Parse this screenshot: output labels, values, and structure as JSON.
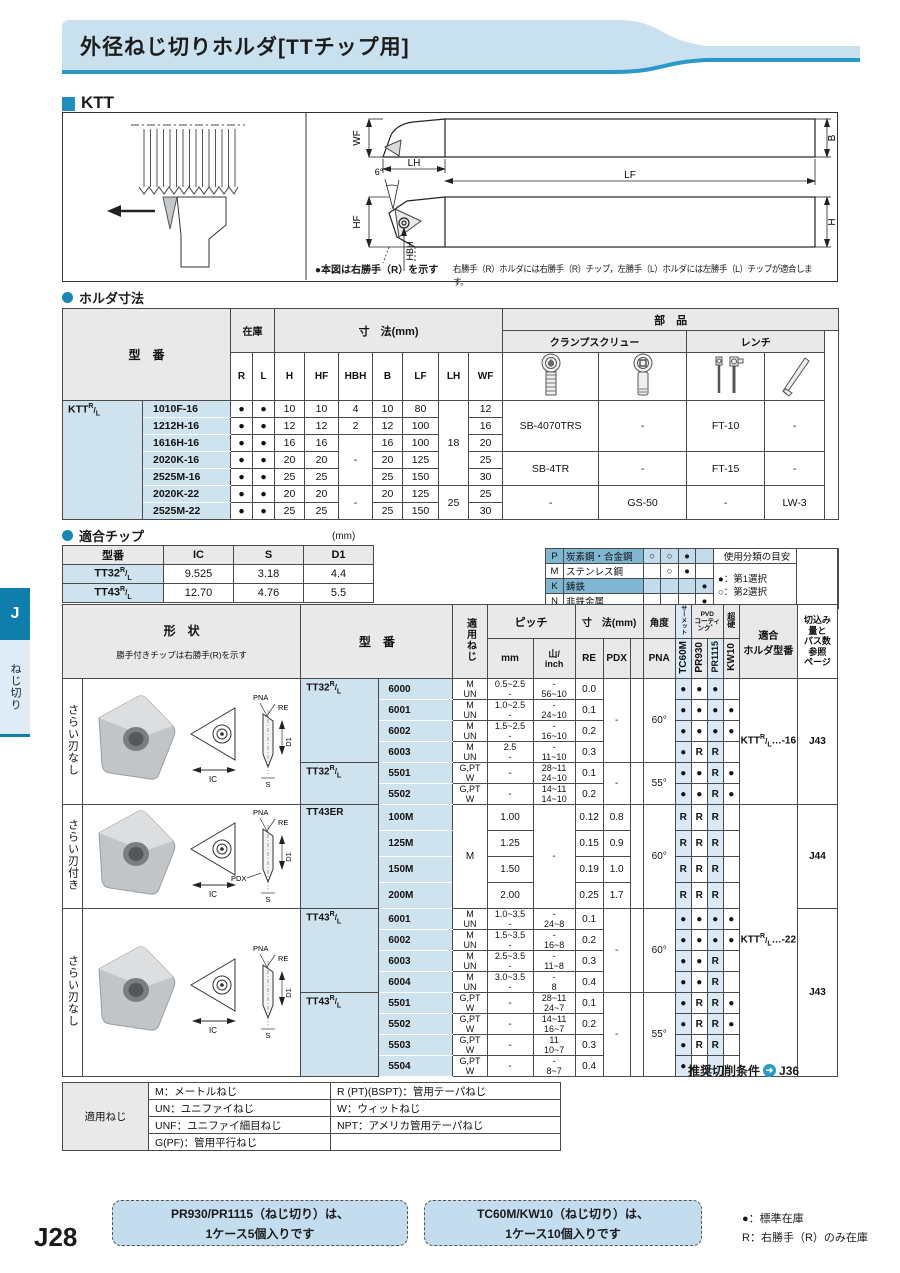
{
  "tab": {
    "letter": "J",
    "label": "ねじ切り"
  },
  "page_no": "J28",
  "header": {
    "title": "外径ねじ切りホルダ[TTチップ用]"
  },
  "ktt": {
    "label": "KTT"
  },
  "diagram": {
    "dims": {
      "wf": "WF",
      "b": "B",
      "lh": "LH",
      "lf": "LF",
      "deg": "6°",
      "hf": "HF",
      "hbh": "HBH",
      "h": "H"
    },
    "note_left": "●本図は右勝手（R）を示す",
    "note_right": "右勝手（R）ホルダには右勝手（R）チップ，左勝手（L）ホルダには左勝手（L）チップが適合します。"
  },
  "holder": {
    "title": "ホルダ寸法",
    "h": {
      "model": "型　番",
      "stock": "在庫",
      "dims": "寸　法(mm)",
      "parts": "部　品",
      "screw": "クランプスクリュー",
      "wrench": "レンチ",
      "r": "R",
      "l": "L",
      "c1": "H",
      "c2": "HF",
      "c3": "HBH",
      "c4": "B",
      "c5": "LF",
      "c6": "LH",
      "c7": "WF"
    },
    "prefix": {
      "base": "KTT",
      "rt": "R",
      "rb": "L"
    },
    "rows": [
      {
        "model": "1010F-16",
        "H": "10",
        "HF": "10",
        "HBH": "4",
        "B": "10",
        "LF": "80",
        "WF": "12"
      },
      {
        "model": "1212H-16",
        "H": "12",
        "HF": "12",
        "HBH": "2",
        "B": "12",
        "LF": "100",
        "WF": "16"
      },
      {
        "model": "1616H-16",
        "H": "16",
        "HF": "16",
        "B": "16",
        "LF": "100",
        "WF": "20"
      },
      {
        "model": "2020K-16",
        "H": "20",
        "HF": "20",
        "B": "20",
        "LF": "125",
        "WF": "25"
      },
      {
        "model": "2525M-16",
        "H": "25",
        "HF": "25",
        "B": "25",
        "LF": "150",
        "WF": "30"
      },
      {
        "model": "2020K-22",
        "H": "20",
        "HF": "20",
        "B": "20",
        "LF": "125",
        "WF": "25"
      },
      {
        "model": "2525M-22",
        "H": "25",
        "HF": "25",
        "B": "25",
        "LF": "150",
        "WF": "30"
      }
    ],
    "merged": {
      "hbh_mid": "-",
      "hbh_bot": "-",
      "lh_top": "18",
      "lh_bot": "25",
      "dot": "●"
    },
    "parts": [
      {
        "screw1": "SB-4070TRS",
        "screw2": "-",
        "wrench1": "FT-10",
        "wrench2": "-"
      },
      {
        "screw1": "SB-4TR",
        "screw2": "-",
        "wrench1": "FT-15",
        "wrench2": "-"
      },
      {
        "screw1": "-",
        "screw2": "GS-50",
        "wrench1": "-",
        "wrench2": "LW-3"
      }
    ]
  },
  "chip": {
    "title": "適合チップ",
    "unit": "(mm)",
    "h": {
      "model": "型番",
      "ic": "IC",
      "s": "S",
      "d1": "D1"
    },
    "rows": [
      {
        "base": "TT32",
        "rt": "R",
        "rb": "L",
        "ic": "9.525",
        "s": "3.18",
        "d1": "4.4"
      },
      {
        "base": "TT43",
        "rt": "R",
        "rb": "L",
        "ic": "12.70",
        "s": "4.76",
        "d1": "5.5"
      }
    ]
  },
  "legend": {
    "rows": [
      {
        "code": "P",
        "name": "炭素鋼・合金鋼",
        "m1": "○",
        "m2": "○",
        "m3": "●",
        "m4": ""
      },
      {
        "code": "M",
        "name": "ステンレス鋼",
        "m1": "",
        "m2": "○",
        "m3": "●",
        "m4": ""
      },
      {
        "code": "K",
        "name": "鋳鉄",
        "m1": "",
        "m2": "",
        "m3": "",
        "m4": "●"
      },
      {
        "code": "N",
        "name": "非鉄金属",
        "m1": "",
        "m2": "",
        "m3": "",
        "m4": "●"
      }
    ],
    "guide_title": "使用分類の目安",
    "first": "●：第1選択",
    "second": "○：第2選択"
  },
  "main": {
    "h": {
      "shape": "形　状",
      "shape_note": "勝手付きチップは右勝手(R)を示す",
      "model": "型　番",
      "thread": "適用ねじ",
      "pitch": "ピッチ",
      "mm": "mm",
      "inch1": "山/",
      "inch2": "inch",
      "dims": "寸　法(mm)",
      "re": "RE",
      "pdx": "PDX",
      "angle": "角度",
      "pna": "PNA",
      "cermet": "サーメット",
      "pvd1": "PVD",
      "pvd2": "コーティンク゛",
      "carbide": "超硬",
      "g1": "TC60M",
      "g2": "PR930",
      "g3": "PR1115",
      "g4": "KW10",
      "holder1": "適合",
      "holder2": "ホルダ型番",
      "pg1": "切込み",
      "pg2": "量と",
      "pg3": "パス数",
      "pg4": "参照",
      "pg5": "ページ"
    },
    "shape_labels": {
      "pna": "PNA",
      "re": "RE",
      "d1": "D1",
      "s": "S",
      "ic": "IC",
      "pdx": "PDX"
    },
    "rows": [
      {
        "glabel": "さらい刃なし",
        "pfx": "TT32",
        "rlt": "R",
        "rlb": "L",
        "no": "6000",
        "t1": "M",
        "t2": "UN",
        "m1": "0.5~2.5",
        "m2": "-",
        "i1": "-",
        "i2": "56~10",
        "re": "0.0",
        "pdx": "-",
        "pna": "60°",
        "c1": "●",
        "c2": "●",
        "c3": "●",
        "hb": "KTT",
        "hrt": "R",
        "hrb": "L",
        "ht": "…-16",
        "pg": "J43"
      },
      {
        "no": "6001",
        "t1": "M",
        "t2": "UN",
        "m1": "1.0~2.5",
        "m2": "-",
        "i1": "-",
        "i2": "24~10",
        "re": "0.1",
        "c1": "●",
        "c2": "●",
        "c3": "●",
        "c4": "●"
      },
      {
        "no": "6002",
        "t1": "M",
        "t2": "UN",
        "m1": "1.5~2.5",
        "m2": "-",
        "i1": "-",
        "i2": "16~10",
        "re": "0.2",
        "c1": "●",
        "c2": "●",
        "c3": "●",
        "c4": "●"
      },
      {
        "no": "6003",
        "t1": "M",
        "t2": "UN",
        "m1": "2.5",
        "m2": "-",
        "i1": "-",
        "i2": "11~10",
        "re": "0.3",
        "c1": "●",
        "c2": "R",
        "c3": "R"
      },
      {
        "pfx": "TT32",
        "rlt": "R",
        "rlb": "L",
        "no": "5501",
        "t1": "G,PT",
        "t2": "W",
        "m1": "-",
        "i1": "28~11",
        "i2": "24~10",
        "re": "0.1",
        "pdx": "-",
        "pna": "55°",
        "c1": "●",
        "c2": "●",
        "c3": "R",
        "c4": "●"
      },
      {
        "no": "5502",
        "t1": "G,PT",
        "t2": "W",
        "m1": "-",
        "i1": "14~11",
        "i2": "14~10",
        "re": "0.2",
        "c1": "●",
        "c2": "●",
        "c3": "R",
        "c4": "●"
      },
      {
        "glabel": "さらい刃付き",
        "pfx": "TT43ER",
        "no": "100M",
        "t1": "M",
        "m1": "1.00",
        "i1": "-",
        "re": "0.12",
        "pdx": "0.8",
        "pna": "60°",
        "c1": "R",
        "c2": "R",
        "c3": "R",
        "hb": "KTT",
        "hrt": "R",
        "hrb": "L",
        "ht": "…-22",
        "pg": "J44"
      },
      {
        "no": "125M",
        "m1": "1.25",
        "re": "0.15",
        "pdx": "0.9",
        "c1": "R",
        "c2": "R",
        "c3": "R"
      },
      {
        "no": "150M",
        "m1": "1.50",
        "re": "0.19",
        "pdx": "1.0",
        "c1": "R",
        "c2": "R",
        "c3": "R"
      },
      {
        "no": "200M",
        "m1": "2.00",
        "re": "0.25",
        "pdx": "1.7",
        "c1": "R",
        "c2": "R",
        "c3": "R"
      },
      {
        "glabel": "さらい刃なし",
        "pfx": "TT43",
        "rlt": "R",
        "rlb": "L",
        "no": "6001",
        "t1": "M",
        "t2": "UN",
        "m1": "1.0~3.5",
        "m2": "-",
        "i1": "-",
        "i2": "24~8",
        "re": "0.1",
        "pdx": "-",
        "pna": "60°",
        "c1": "●",
        "c2": "●",
        "c3": "●",
        "c4": "●",
        "pg": "J43"
      },
      {
        "no": "6002",
        "t1": "M",
        "t2": "UN",
        "m1": "1.5~3.5",
        "m2": "-",
        "i1": "-",
        "i2": "16~8",
        "re": "0.2",
        "c1": "●",
        "c2": "●",
        "c3": "●",
        "c4": "●"
      },
      {
        "no": "6003",
        "t1": "M",
        "t2": "UN",
        "m1": "2.5~3.5",
        "m2": "-",
        "i1": "-",
        "i2": "11~8",
        "re": "0.3",
        "c1": "●",
        "c2": "●",
        "c3": "R"
      },
      {
        "no": "6004",
        "t1": "M",
        "t2": "UN",
        "m1": "3.0~3.5",
        "m2": "-",
        "i1": "-",
        "i2": "8",
        "re": "0.4",
        "c1": "●",
        "c2": "●",
        "c3": "R"
      },
      {
        "pfx": "TT43",
        "rlt": "R",
        "rlb": "L",
        "no": "5501",
        "t1": "G,PT",
        "t2": "W",
        "m1": "-",
        "i1": "28~11",
        "i2": "24~7",
        "re": "0.1",
        "pdx": "-",
        "pna": "55°",
        "c1": "●",
        "c2": "R",
        "c3": "R",
        "c4": "●"
      },
      {
        "no": "5502",
        "t1": "G,PT",
        "t2": "W",
        "m1": "-",
        "i1": "14~11",
        "i2": "16~7",
        "re": "0.2",
        "c1": "●",
        "c2": "R",
        "c3": "R",
        "c4": "●"
      },
      {
        "no": "5503",
        "t1": "G,PT",
        "t2": "W",
        "m1": "-",
        "i1": "11",
        "i2": "10~7",
        "re": "0.3",
        "c1": "●",
        "c2": "R",
        "c3": "R"
      },
      {
        "no": "5504",
        "t1": "G,PT",
        "t2": "W",
        "m1": "-",
        "i1": "-",
        "i2": "8~7",
        "re": "0.4",
        "c1": "●"
      }
    ]
  },
  "recommend": {
    "label": "推奨切削条件",
    "arrow": "➜",
    "page": "J36"
  },
  "thread_legend": {
    "title": "適用ねじ",
    "r0a": "M：メートルねじ",
    "r0b": "R (PT)(BSPT)：管用テーパねじ",
    "r1a": "UN：ユニファイねじ",
    "r1b": "W：ウィットねじ",
    "r2a": "UNF：ユニファイ細目ねじ",
    "r2b": "NPT：アメリカ管用テーパねじ",
    "r3a": "G(PF)：管用平行ねじ",
    "r3b": ""
  },
  "notes": {
    "box1a": "PR930/PR1115（ねじ切り）は、",
    "box1b": "1ケース5個入りです",
    "box2a": "TC60M/KW10（ねじ切り）は、",
    "box2b": "1ケース10個入りです",
    "stock1": "●：標準在庫",
    "stock2": "R：右勝手（R）のみ在庫"
  }
}
